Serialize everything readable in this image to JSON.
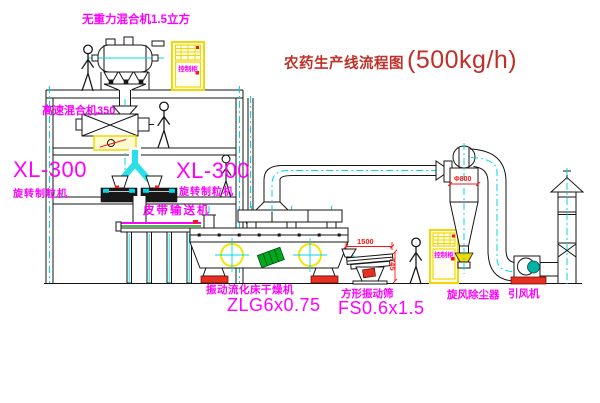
{
  "title": {
    "text": "农药生产线流程图",
    "capacity": "(500kg/h)"
  },
  "labels": {
    "gravity_mixer": "无重力混合机1.5立方",
    "high_speed_mixer": "高速混合机350",
    "granulator_left_model": "XL-300",
    "granulator_left_name": "旋转制粒机",
    "granulator_right_model": "XL-300",
    "granulator_right_name": "旋转制粒机",
    "belt_conveyor": "皮带输送机",
    "dryer_name": "振动流化床干燥机",
    "dryer_model": "ZLG6x0.75",
    "sieve_name": "方形振动筛",
    "sieve_model": "FS0.6x1.5",
    "cyclone_name": "旋风除尘器",
    "fan_name": "引风机",
    "cabinet_top": "控制柜",
    "cabinet_right": "控制柜"
  },
  "dimensions": {
    "sieve_length": "1500",
    "sieve_height": "745",
    "cyclone_diameter": "Φ800"
  },
  "colors": {
    "label": "#ff00ff",
    "title": "#c03028",
    "dimension": "#ff1414",
    "centerline": "#00d8e6",
    "chute": "#2adfe8",
    "cabinet": "#f0d800",
    "motor": "#00a81e",
    "fan": "#00b2a6",
    "base": "#e83020",
    "belt": "#00a800",
    "line": "#151515",
    "dark": "#181818",
    "crosshair": "#f5e400"
  }
}
